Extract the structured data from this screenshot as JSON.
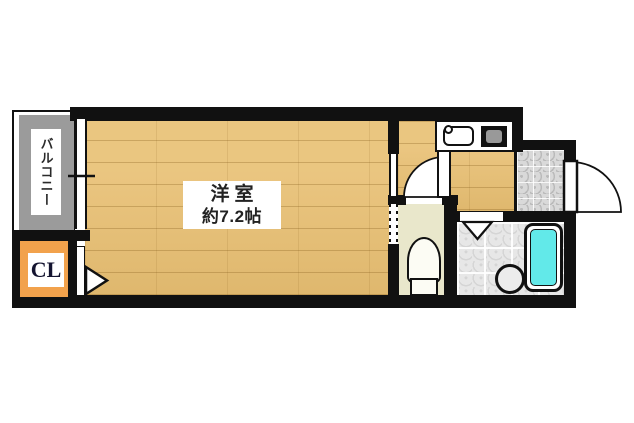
{
  "plan_type": "apartment-floor-plan",
  "rooms": {
    "main_room": {
      "name": "洋室",
      "size": "約7.2帖"
    },
    "balcony": {
      "label": "バルコニー"
    },
    "closet": {
      "label": "CL"
    }
  },
  "fixtures": {
    "kitchen": [
      "sink-icon",
      "stove-icon"
    ],
    "toilet": [
      "toilet-icon"
    ],
    "bathroom": [
      "bathtub-icon",
      "washbasin-icon",
      "folding-door-mark"
    ],
    "doors": [
      "entry-door-swing",
      "toilet-door-swing",
      "closet-door-mark"
    ],
    "window": [
      "balcony-window"
    ]
  },
  "colors": {
    "wall": "#111111",
    "wood": "#e8bf72",
    "balcony": "#9b9b9b",
    "closet": "#f2a24c",
    "toilet_floor": "#e9e7cb",
    "tile": "#d9d9d9",
    "bath_tile": "#e7e7e7",
    "bathtub": "#62e9e9",
    "text": "#222222",
    "bg": "#ffffff"
  }
}
